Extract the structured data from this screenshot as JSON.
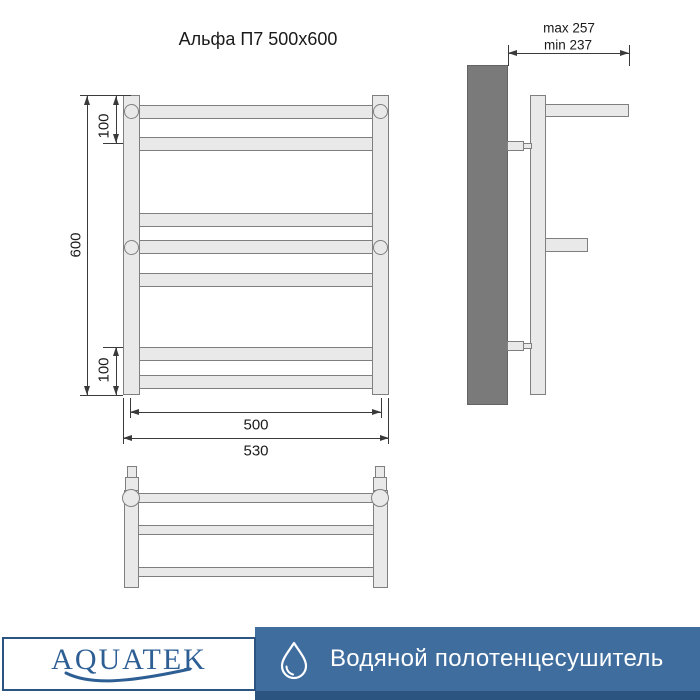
{
  "title": "Альфа П7 500x600",
  "front_view": {
    "dim_height": "600",
    "dim_top": "100",
    "dim_bottom": "100",
    "dim_inner_width": "500",
    "dim_outer_width": "530"
  },
  "side_view": {
    "dim_max": "max 257",
    "dim_min": "min 237"
  },
  "footer": {
    "brand": "AQUATEK",
    "product": "Водяной полотенцесушитель"
  },
  "icons": {
    "drop": "water-drop-icon",
    "wave": "logo-wave-icon"
  },
  "colors": {
    "accent_blue": "#3E6D9E",
    "dark_blue": "#2B5480",
    "logo_blue": "#2E5F94",
    "metal_fill": "#E9E9E9",
    "metal_stroke": "#7F7F7F",
    "wall_gray": "#7A7A7A",
    "line": "#3A3A3A",
    "text": "#1A1A1A"
  }
}
